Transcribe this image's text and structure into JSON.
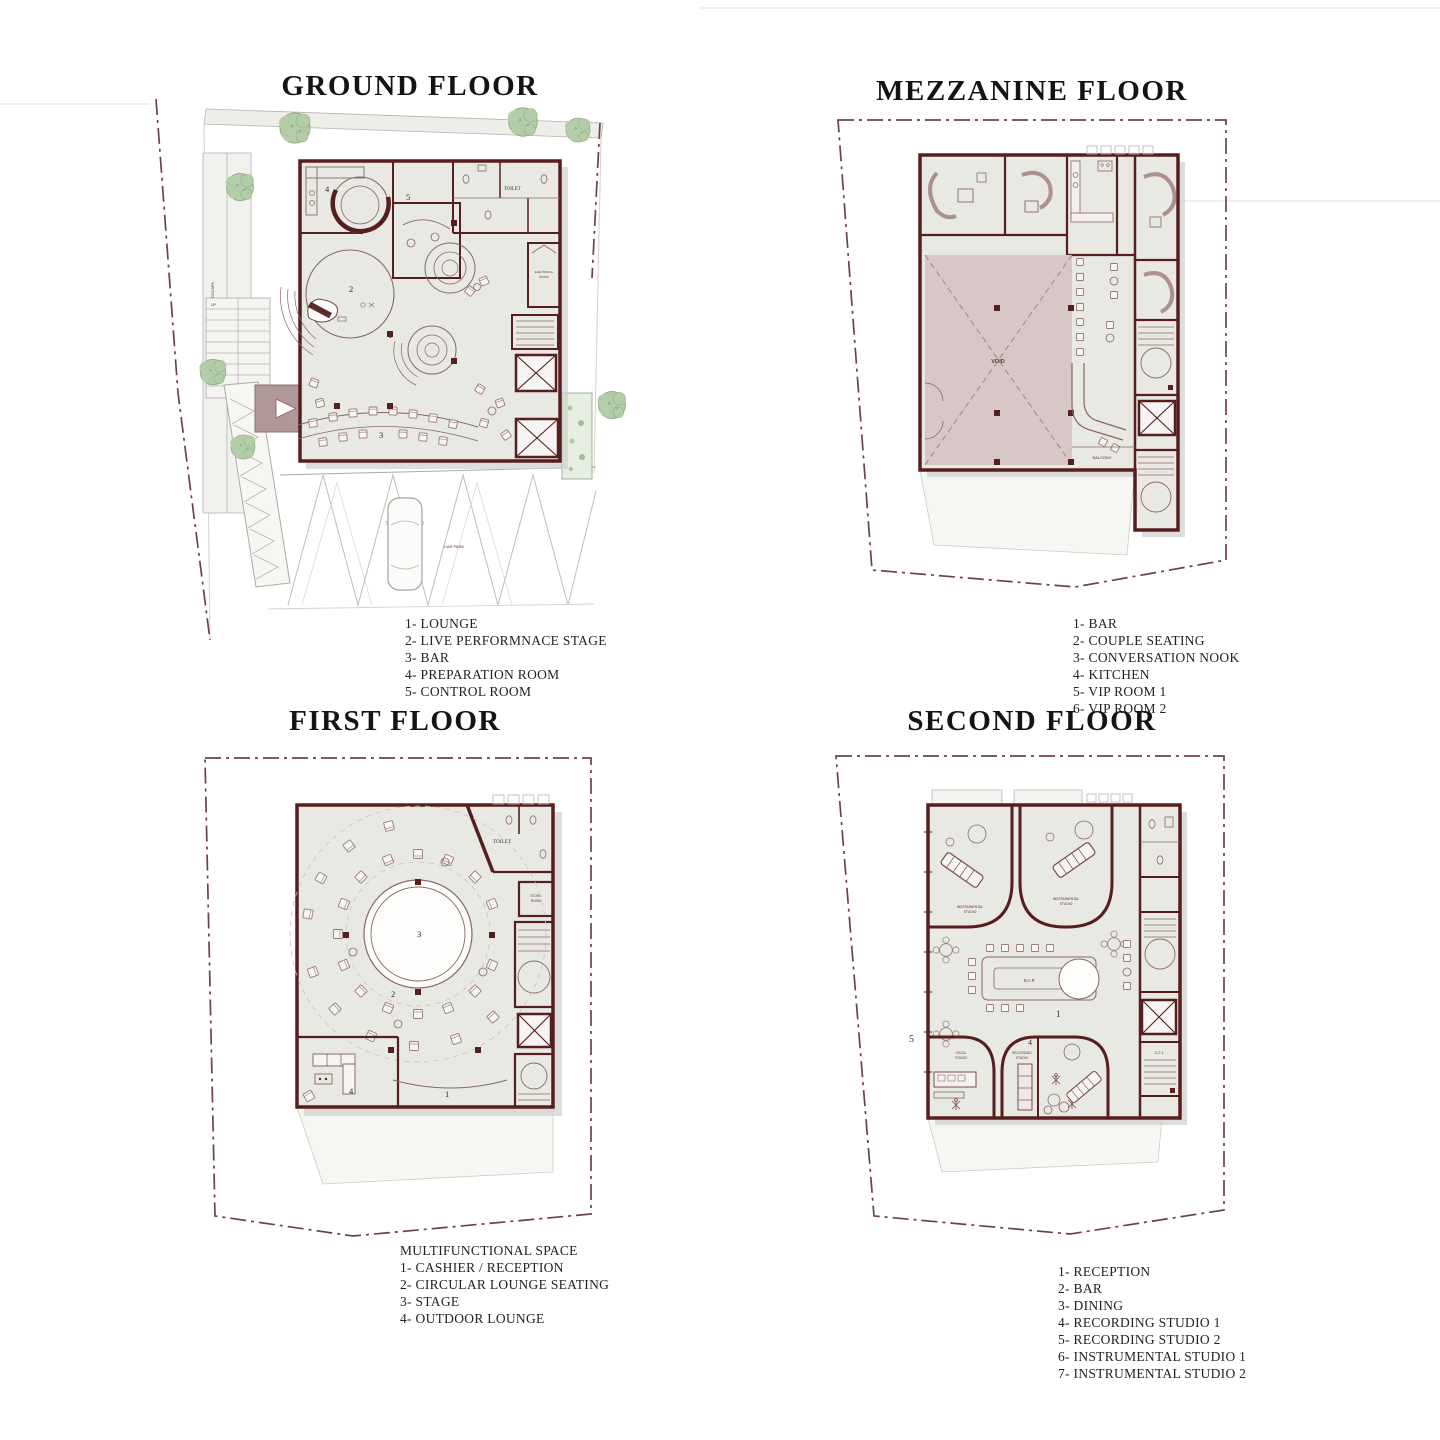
{
  "colors": {
    "c-wall": "#571e1e",
    "c-line": "#8a6666",
    "c-boundary": "#6e4343",
    "c-floor": "#e9e9e4",
    "c-void": "#d7c7c7",
    "c-tree": "#b2cda7",
    "c-treedge": "#8fae85",
    "c-entr": "#b19797",
    "c-shadow": "#cfcfcc",
    "c-ink": "#1c1c1c",
    "c-site": "#f1f2ee"
  },
  "plans": {
    "ground": {
      "title": "GROUND FLOOR",
      "legend": [
        "1- LOUNGE",
        "2- LIVE PERFORMNACE STAGE",
        "3- BAR",
        "4- PREPARATION ROOM",
        "5- CONTROL ROOM"
      ],
      "labels": {
        "toilet": "TOILET",
        "electrical_1": "ELECTRICAL",
        "electrical_2": "ROOM",
        "landscape": "LANDSCAPE",
        "carpark": "CAR PARK",
        "up": "UP"
      },
      "numbers": {
        "n1": "1",
        "n2": "2",
        "n3": "3",
        "n4": "4",
        "n5": "5"
      }
    },
    "mezzanine": {
      "title": "MEZZANINE FLOOR",
      "legend": [
        "1- BAR",
        "2- COUPLE SEATING",
        "3- CONVERSATION NOOK",
        "4- KITCHEN",
        "5- VIP ROOM 1",
        "6- VIP ROOM 2"
      ],
      "labels": {
        "void": "VOID",
        "balcony": "BALCONY"
      }
    },
    "first": {
      "title": "FIRST FLOOR",
      "legend_header": "MULTIFUNCTIONAL SPACE",
      "legend": [
        "1- CASHIER / RECEPTION",
        "2- CIRCULAR LOUNGE SEATING",
        "3- STAGE",
        "4- OUTDOOR LOUNGE"
      ],
      "labels": {
        "toilet": "TOILET",
        "store_1": "STORE",
        "store_2": "ROOM"
      },
      "numbers": {
        "n1": "1",
        "n2": "2",
        "n3": "3",
        "n4": "4"
      }
    },
    "second": {
      "title": "SECOND FLOOR",
      "legend": [
        "1- RECEPTION",
        "2- BAR",
        "3- DINING",
        "4- RECORDING STUDIO 1",
        "5- RECORDING STUDIO 2",
        "6- INSTRUMENTAL STUDIO 1",
        "7- INSTRUMENTAL STUDIO 2"
      ],
      "labels": {
        "instrumental_1": "INSTRUMENTAL",
        "instrumental_2": "STUDIO",
        "vocal_1": "VOCAL",
        "vocal_2": "STUDIO",
        "recording_1": "RECORDING",
        "recording_2": "STUDIO",
        "bar": "BAR",
        "sc1": "S.C 1"
      },
      "numbers": {
        "n1": "1",
        "n4": "4",
        "n5": "5"
      }
    }
  }
}
